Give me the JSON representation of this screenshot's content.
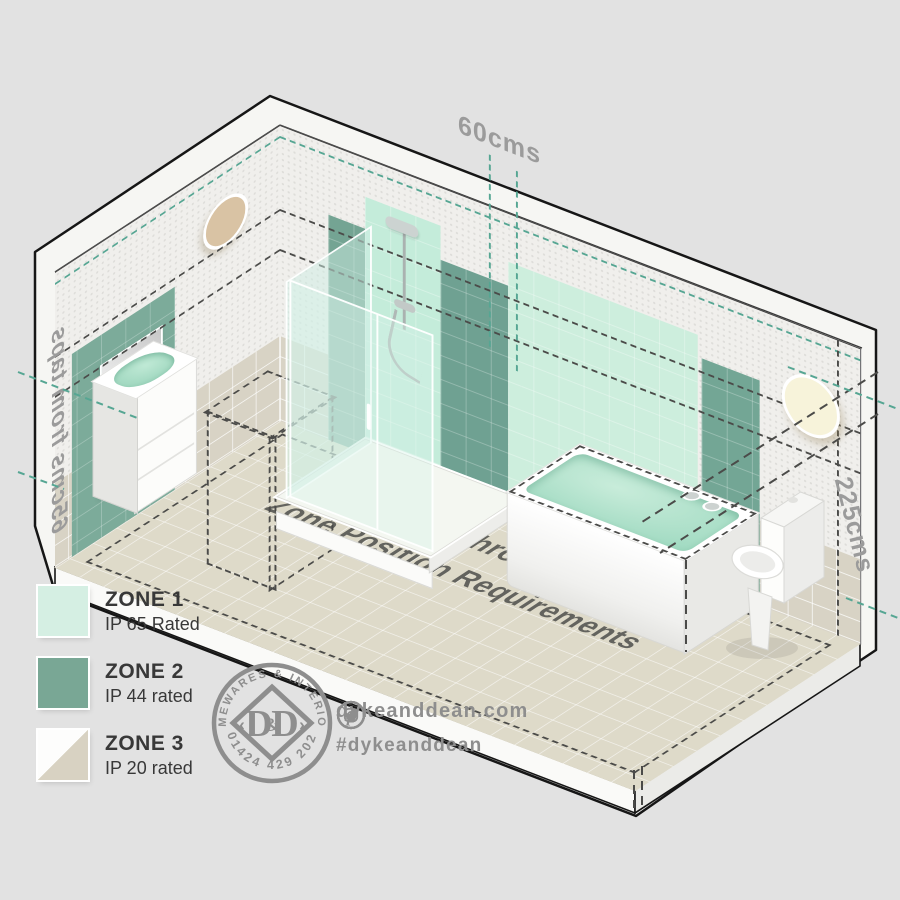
{
  "diagram": {
    "floor_title": {
      "line1": "IP Rated Bathroom Lighting",
      "line2": "Zone Position Requirements"
    },
    "measurements": {
      "top": "60cms",
      "left": "65cms from taps",
      "right": "225cms"
    },
    "fixtures": [
      "basin-vanity",
      "mirror",
      "wall-light-left",
      "shower-enclosure",
      "bath",
      "toilet",
      "wall-light-right"
    ]
  },
  "legend": {
    "items": [
      {
        "zone": "ZONE 1",
        "rating": "IP 65 Rated",
        "color": "#d5efe3"
      },
      {
        "zone": "ZONE 2",
        "rating": "IP 44 rated",
        "color": "#79a795"
      },
      {
        "zone": "ZONE 3",
        "rating": "IP 20 rated",
        "color_top": "#fdfdfc",
        "color_bottom": "#d8d2c2"
      }
    ]
  },
  "logo": {
    "arc_top": "HOMEWARES & INTERIORS",
    "arc_bottom": "01424 429 202",
    "monogram_left": "D",
    "monogram_amp": "&",
    "monogram_right": "D"
  },
  "footer": {
    "website": "dykeanddean.com",
    "hashtag": "#dykeanddean",
    "social": [
      "instagram",
      "twitter",
      "facebook",
      "pinterest"
    ]
  },
  "colors": {
    "zone1": "#cdeedd",
    "zone2": "#7cab9a",
    "zone3_tile": "#d8d2c2",
    "teal_dash": "#56a693",
    "black_dash": "#4b4b49",
    "brand_gray": "#8e8e8e",
    "floor": "#dedac9"
  }
}
